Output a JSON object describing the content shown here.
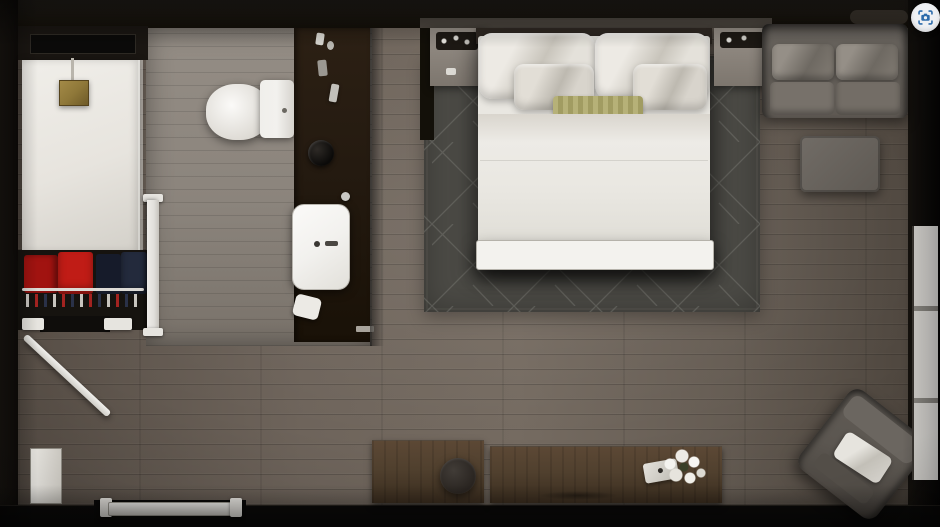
{
  "meta": {
    "description": "Top-down 3D rendering of a hotel studio room floor plan",
    "room_zones": [
      "shower",
      "closet",
      "bathroom-vanity",
      "entry",
      "sleeping-area",
      "lounge",
      "desk-area"
    ]
  },
  "controls": {
    "camera_button": {
      "icon": "camera-focus-icon"
    }
  },
  "palette": {
    "outer": "#0d0b0a",
    "wall": "#1b1713",
    "floor-wood": "#6e645b",
    "floor-bath": "#8b847c",
    "shower-white": "#e7e4de",
    "brass": "#8f7839",
    "vanity-wood": "#241a10",
    "porcelain": "#f2f1ee",
    "red-garment": "#c01c16",
    "red-garment-2": "#a11310",
    "navy-garment": "#161b2a",
    "navy-garment-2": "#232a3c",
    "door-white": "#e0dedA",
    "rug": "#4b4a45",
    "rug-line": "#90908a",
    "bed-white": "#e9e7e1",
    "accent-pillow": "#b6b178",
    "sofa-gray": "#6c6761",
    "chair-gray": "#5b5650",
    "desk-wood": "#50402e",
    "stool-dark": "#292420",
    "window-white": "#e9e7e3",
    "button-bg": "#eef0f3",
    "button-icon": "#2e6cab"
  },
  "objects": {
    "bed": "king bed with pillows",
    "foot_bench": "white bench at foot of bed",
    "rug": "dark geometric area rug",
    "sofa": "two-seat gray sofa",
    "ottoman": "gray ottoman",
    "armchair": "angled lounge armchair with white pillow",
    "desk": "wood console desk along bottom wall",
    "stool": "round dark stool",
    "flowers": "white flower arrangement on desk",
    "toilet": "toilet",
    "sink": "rectangular vanity sink",
    "shower": "walk-in shower with brass head",
    "closet": "closet with red and navy garments on rail",
    "nightstands": "pair of nightstands with trays",
    "entry_door": "entry door in bottom wall",
    "bathroom_door": "door open at 45 degrees",
    "sliding_door": "white sliding bathroom door",
    "window": "window strip on right wall"
  }
}
